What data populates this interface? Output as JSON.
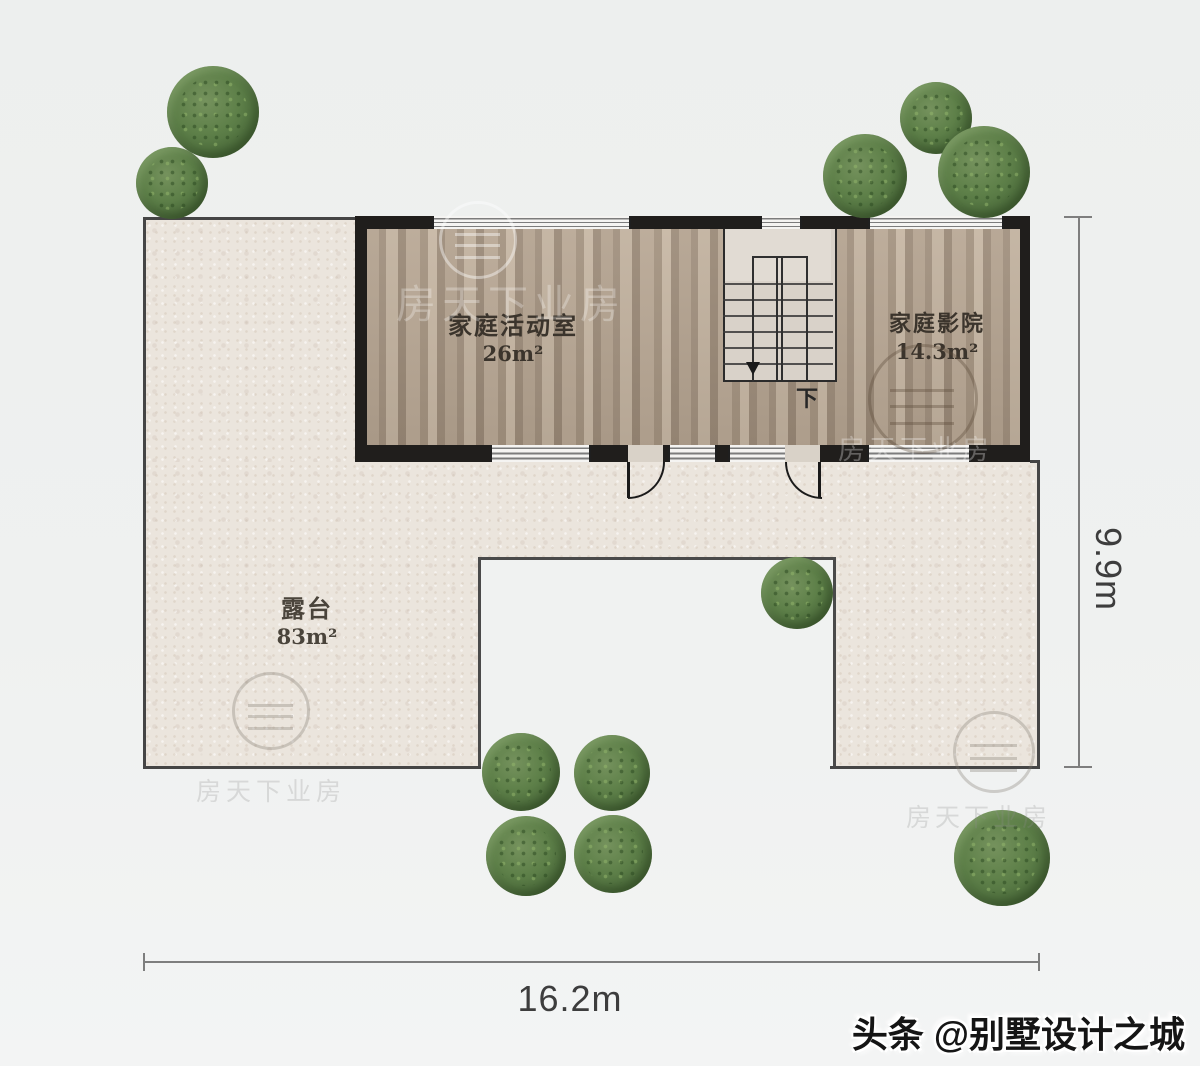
{
  "plan": {
    "rooms": [
      {
        "id": "family-activity-room",
        "label": "家庭活动室",
        "area": "26m²"
      },
      {
        "id": "home-theater",
        "label": "家庭影院",
        "area": "14.3m²"
      },
      {
        "id": "terrace",
        "label": "露台",
        "area": "83m²"
      }
    ],
    "stairs": {
      "down_label": "下"
    },
    "dimensions": {
      "width": "16.2m",
      "height": "9.9m"
    },
    "colors": {
      "wall": "#201e1c",
      "wood_floor": "#ab9a88",
      "terrace": "#ebe5dd",
      "tree": "#5e8049",
      "background": "#eef0ef"
    },
    "tree_count": 11
  },
  "watermark": {
    "brand": "头条 @别墅设计之城",
    "ghost_text": "房天下业房"
  }
}
